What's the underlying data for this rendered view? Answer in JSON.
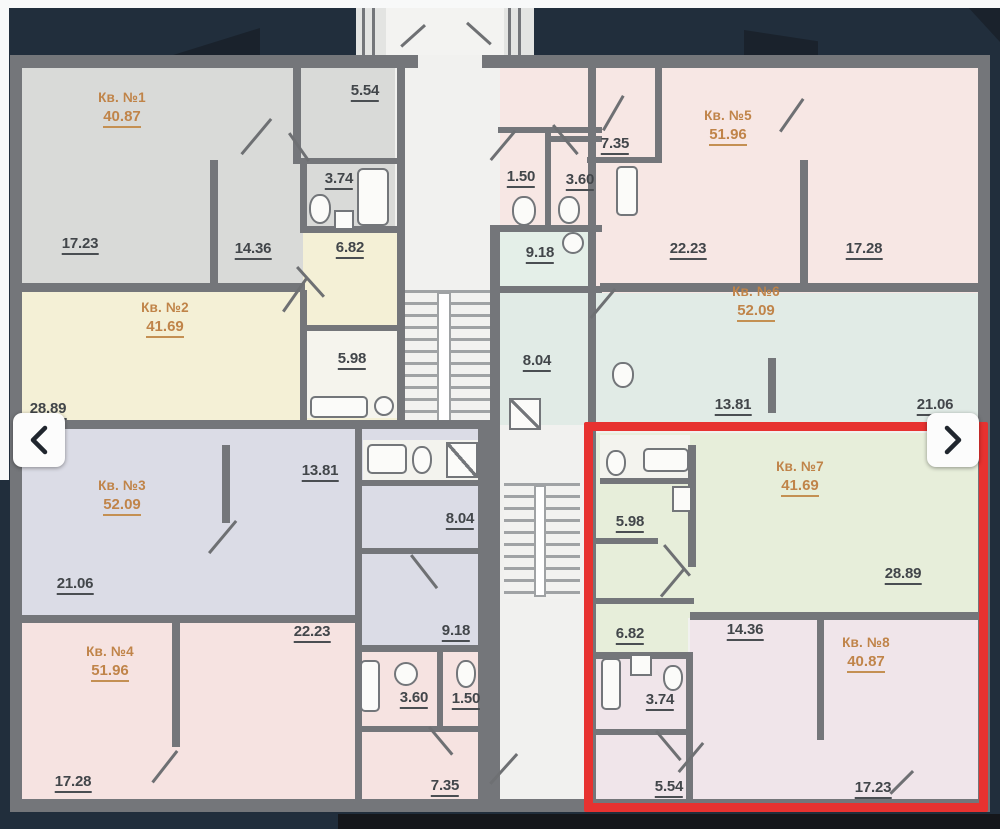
{
  "page": {
    "background": "#212e3c",
    "bottom_bar_color": "#15171b"
  },
  "viewer": {
    "prev_icon": "chevron-left",
    "next_icon": "chevron-right",
    "highlight_color": "#e73230"
  },
  "plan": {
    "apartment_label_color": "#c08449",
    "room_label_color": "#42464a",
    "wall_color": "#74767a",
    "apartments": [
      {
        "name": "Кв. №1",
        "area": "40.87",
        "fill": "#d9dad8"
      },
      {
        "name": "Кв. №2",
        "area": "41.69",
        "fill": "#f4f0d6"
      },
      {
        "name": "Кв. №3",
        "area": "52.09",
        "fill": "#dbdce6"
      },
      {
        "name": "Кв. №4",
        "area": "51.96",
        "fill": "#f6e3e1"
      },
      {
        "name": "Кв. №5",
        "area": "51.96",
        "fill": "#f7e7e4"
      },
      {
        "name": "Кв. №6",
        "area": "52.09",
        "fill": "#e1ebe6"
      },
      {
        "name": "Кв. №7",
        "area": "41.69",
        "fill": "#e7eeda"
      },
      {
        "name": "Кв. №8",
        "area": "40.87",
        "fill": "#f0e5ea"
      }
    ],
    "rooms": [
      {
        "area": "5.54"
      },
      {
        "area": "3.74"
      },
      {
        "area": "17.23"
      },
      {
        "area": "14.36"
      },
      {
        "area": "6.82"
      },
      {
        "area": "5.98"
      },
      {
        "area": "28.89"
      },
      {
        "area": "13.81"
      },
      {
        "area": "8.04"
      },
      {
        "area": "21.06"
      },
      {
        "area": "9.18"
      },
      {
        "area": "22.23"
      },
      {
        "area": "3.60"
      },
      {
        "area": "1.50"
      },
      {
        "area": "7.35"
      },
      {
        "area": "17.28"
      },
      {
        "area": "7.35"
      },
      {
        "area": "1.50"
      },
      {
        "area": "3.60"
      },
      {
        "area": "9.18"
      },
      {
        "area": "22.23"
      },
      {
        "area": "17.28"
      },
      {
        "area": "8.04"
      },
      {
        "area": "13.81"
      },
      {
        "area": "21.06"
      },
      {
        "area": "5.98"
      },
      {
        "area": "28.89"
      },
      {
        "area": "6.82"
      },
      {
        "area": "14.36"
      },
      {
        "area": "3.74"
      },
      {
        "area": "5.54"
      },
      {
        "area": "17.23"
      }
    ]
  }
}
